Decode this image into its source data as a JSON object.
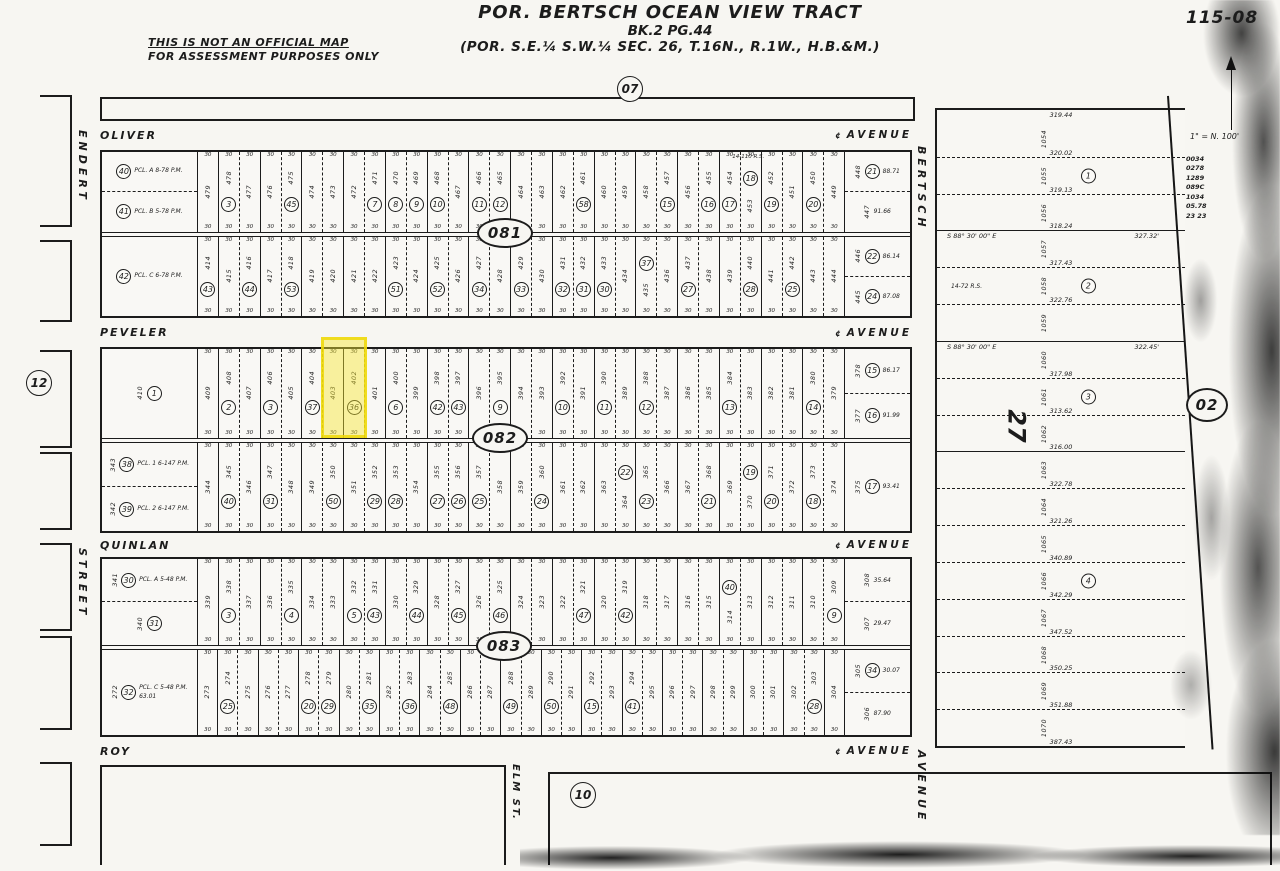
{
  "header": {
    "disclaimer_line1": "THIS IS NOT AN OFFICIAL MAP",
    "disclaimer_line2": "FOR ASSESSMENT PURPOSES ONLY",
    "title_line1": "POR. BERTSCH OCEAN VIEW TRACT",
    "title_line2": "BK.2 PG.44",
    "title_line3": "(POR.  S.E.¼ S.W.¼  SEC. 26,  T.16N.,  R.1W.,  H.B.&M.)",
    "sheet_number": "115-08",
    "scale_note": "1\" = N. 100'"
  },
  "streets": {
    "oliver": {
      "name": "OLIVER",
      "type": "AVENUE"
    },
    "peveler": {
      "name": "PEVELER",
      "type": "AVENUE"
    },
    "quinlan": {
      "name": "QUINLAN",
      "type": "AVENUE"
    },
    "roy": {
      "name": "ROY",
      "type": "AVENUE"
    },
    "endert": {
      "name": "ENDERT",
      "type": "STREET"
    },
    "bertsch": {
      "name": "BERTSCH",
      "type": "AVENUE"
    },
    "elm": {
      "name": "ELM",
      "type": "ST."
    }
  },
  "adjacent_blocks": {
    "north": "07",
    "west": "12",
    "south": "10",
    "east": "02"
  },
  "centerline_symbol": "¢",
  "highlight": {
    "circle": "36",
    "lots": "403, 402",
    "color": "#f0e034"
  },
  "blocks": [
    {
      "id": "081",
      "north": {
        "frontage": "30",
        "corner_left": [
          {
            "c": "40",
            "tag": "PCL. A 8-78 P.M."
          },
          {
            "c": "41",
            "tag": "PCL. B 5-78 P.M."
          }
        ],
        "lots": [
          "479",
          "478:3",
          "477",
          "476",
          "475:45",
          "474",
          "473",
          "472",
          "471:7",
          "470:8",
          "469:9",
          "468:10",
          "467",
          "466:11",
          "465:12",
          "464",
          "463",
          "462",
          "461:58",
          "460",
          "459",
          "458",
          "457:15",
          "456",
          "455:16",
          "454:17",
          "453:18:t",
          "452:19",
          "451",
          "450:20",
          "449"
        ],
        "note": {
          "text": "14-110 R.S.",
          "pos": 0.78
        },
        "corner_right": [
          {
            "c": "21",
            "lot": "448",
            "dim": "88.71"
          },
          {
            "lot": "447",
            "dim": "91.66"
          }
        ]
      },
      "south": {
        "frontage": "30",
        "corner_left": [
          {
            "c": "42",
            "tag": "PCL. C 6-78 P.M."
          }
        ],
        "lots": [
          "414:43",
          "415",
          "416:44",
          "417",
          "418:53",
          "419",
          "420",
          "421",
          "422",
          "423:51",
          "424",
          "425:52",
          "426",
          "427:34",
          "428",
          "429:33",
          "430",
          "431:32",
          "432:31",
          "433:30",
          "434",
          "435:37:t",
          "436",
          "437:27",
          "438",
          "439",
          "440:28",
          "441",
          "442:25",
          "443",
          "444"
        ],
        "corner_right": [
          {
            "c": "22",
            "lot": "446",
            "dim": "86.14"
          },
          {
            "c": "24",
            "lot": "445",
            "dim": "87.08"
          }
        ]
      }
    },
    {
      "id": "082",
      "north": {
        "frontage": "30",
        "corner_left": [
          {
            "c": "1",
            "lot": "410"
          }
        ],
        "lots": [
          "409",
          "408:2",
          "407",
          "406:3",
          "405",
          "404:37",
          "403::hl",
          "402:36:hl",
          "401",
          "400:6",
          "399",
          "398:42",
          "397:43",
          "396",
          "395:9",
          "394",
          "393",
          "392:10",
          "391",
          "390:11",
          "389",
          "388:12",
          "387",
          "386",
          "385",
          "384:13",
          "383",
          "382",
          "381",
          "380:14",
          "379"
        ],
        "corner_right": [
          {
            "c": "15",
            "lot": "378",
            "dim": "86.17"
          },
          {
            "c": "16",
            "lot": "377",
            "dim": "91.99"
          }
        ]
      },
      "south": {
        "frontage": "30",
        "corner_left": [
          {
            "c": "38",
            "lot": "343",
            "tag": "PCL. 1 6-147 P.M."
          },
          {
            "c": "39",
            "lot": "342",
            "tag": "PCL. 2 6-147 P.M."
          }
        ],
        "lots": [
          "344",
          "345:40",
          "346",
          "347:31",
          "348",
          "349",
          "350:50",
          "351",
          "352:29",
          "353:28",
          "354",
          "355:27",
          "356:26",
          "357:25",
          "358",
          "359",
          "360:24",
          "361",
          "362",
          "363",
          "364:22:t",
          "365:23",
          "366",
          "367",
          "368:21",
          "369",
          "370:19:t",
          "371:20",
          "372",
          "373:18",
          "374"
        ],
        "corner_right": [
          {
            "c": "17",
            "lot": "375",
            "dim": "93.41"
          }
        ]
      }
    },
    {
      "id": "083",
      "north": {
        "frontage": "30",
        "corner_left": [
          {
            "c": "30",
            "lot": "341",
            "tag": "PCL. A 5-48 P.M."
          },
          {
            "c": "31",
            "lot": "340"
          }
        ],
        "lots": [
          "339",
          "338:3",
          "337",
          "336",
          "335:4",
          "334",
          "333",
          "332:5",
          "331:43",
          "330",
          "329:44",
          "328",
          "327:45",
          "326",
          "325:46",
          "324",
          "323",
          "322",
          "321:47",
          "320",
          "319:42",
          "318",
          "317",
          "316",
          "315",
          "314:40:t",
          "313",
          "312",
          "311",
          "310",
          "309:9"
        ],
        "corner_right": [
          {
            "lot": "308",
            "dim": "35.64"
          },
          {
            "lot": "307",
            "dim": "29.47"
          }
        ]
      },
      "south": {
        "frontage": "30",
        "corner_left": [
          {
            "c": "32",
            "lot": "272",
            "tag": "PCL. C 5-48 P.M.",
            "dim": "63.01"
          }
        ],
        "lots": [
          "273",
          "274:25",
          "275",
          "276",
          "277",
          "278:20",
          "279:29",
          "280",
          "281:35",
          "282",
          "283:36",
          "284",
          "285:48",
          "286",
          "287",
          "288:49",
          "289",
          "290:50",
          "291",
          "292:15",
          "293",
          "294:41",
          "295",
          "296",
          "297",
          "298",
          "299",
          "300",
          "301",
          "302",
          "303:28",
          "304"
        ],
        "corner_right": [
          {
            "c": "34",
            "lot": "305",
            "dim": "30.07"
          },
          {
            "lot": "306",
            "dim": "87.90"
          }
        ]
      }
    }
  ],
  "east_section": {
    "section_label": "27",
    "east_oval": "02",
    "top_dim": "319.44",
    "rows": [
      {
        "lot": "1054",
        "dim": "320.02"
      },
      {
        "lot": "1055",
        "c": "1",
        "dim": "319.13"
      },
      {
        "lot": "1056",
        "dim": "318.24",
        "solid": true
      },
      {
        "lot": "1057",
        "dim": "317.43",
        "bearing": "S 88° 30' 00\" E",
        "blen": "327.32'"
      },
      {
        "lot": "1058",
        "c": "2",
        "note": "14-72 R.S.",
        "dim": "322.76"
      },
      {
        "lot": "1059",
        "solid": true
      },
      {
        "lot": "1060",
        "dim": "317.98",
        "bearing": "S 88° 30' 00\" E",
        "blen": "322.45'"
      },
      {
        "lot": "1061",
        "c": "3",
        "dim": "313.62"
      },
      {
        "lot": "1062",
        "dim": "316.00",
        "solid": true
      },
      {
        "lot": "1063",
        "dim": "322.78"
      },
      {
        "lot": "1064",
        "dim": "321.26"
      },
      {
        "lot": "1065",
        "dim": "340.89"
      },
      {
        "lot": "1066",
        "c": "4",
        "dim": "342.29"
      },
      {
        "lot": "1067",
        "dim": "347.52"
      },
      {
        "lot": "1068",
        "dim": "350.25"
      },
      {
        "lot": "1069",
        "dim": "351.88"
      },
      {
        "lot": "1070",
        "dim": "387.43"
      }
    ]
  },
  "margin_codes": [
    "0034",
    "0278",
    "1289",
    "089C",
    "1034",
    "05.78",
    "23 23"
  ]
}
